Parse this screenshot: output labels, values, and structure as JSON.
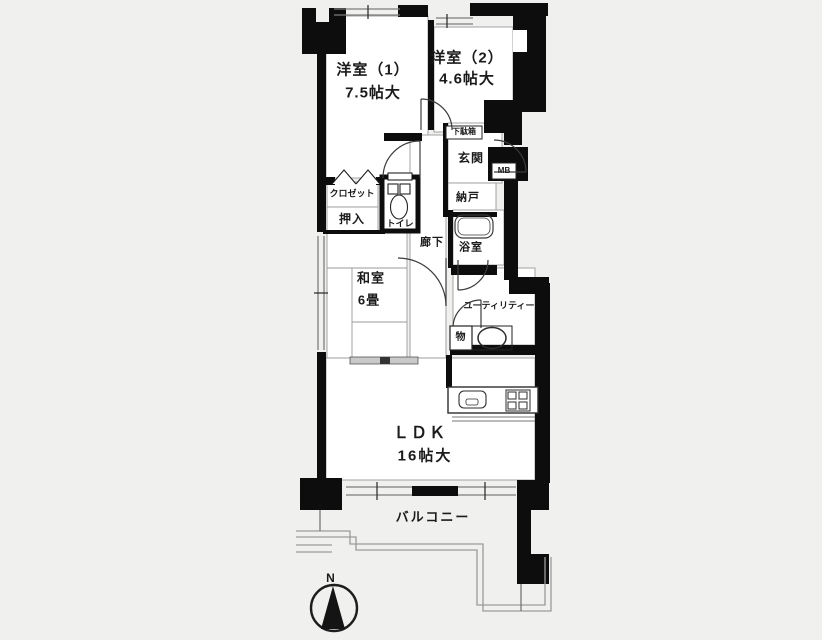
{
  "rooms": {
    "yoshitsu1": {
      "name": "洋室（1）",
      "size": "7.5帖大"
    },
    "yoshitsu2": {
      "name": "洋室（2）",
      "size": "4.6帖大"
    },
    "washitsu": {
      "name": "和室",
      "size": "6畳"
    },
    "ldk": {
      "name": "ＬＤＫ",
      "size": "16帖大"
    },
    "balcony": {
      "name": "バルコニー"
    },
    "genkan": {
      "name": "玄関"
    },
    "getabako": {
      "name": "下駄箱"
    },
    "mb": {
      "name": "MB"
    },
    "nando": {
      "name": "納戸"
    },
    "closet": {
      "name": "クロゼット"
    },
    "oshiire": {
      "name": "押入"
    },
    "toilet": {
      "name": "トイレ"
    },
    "rouka": {
      "name": "廊下"
    },
    "yokushitsu": {
      "name": "浴室"
    },
    "utility": {
      "name": "ユーティリティー"
    },
    "mono": {
      "name": "物"
    }
  },
  "compass": {
    "label": "N"
  },
  "colors": {
    "wall": "#0d0d0d",
    "room_floor": "#ffffff",
    "thin_line": "#8a8a8a",
    "railing": "#9b9b9b"
  }
}
